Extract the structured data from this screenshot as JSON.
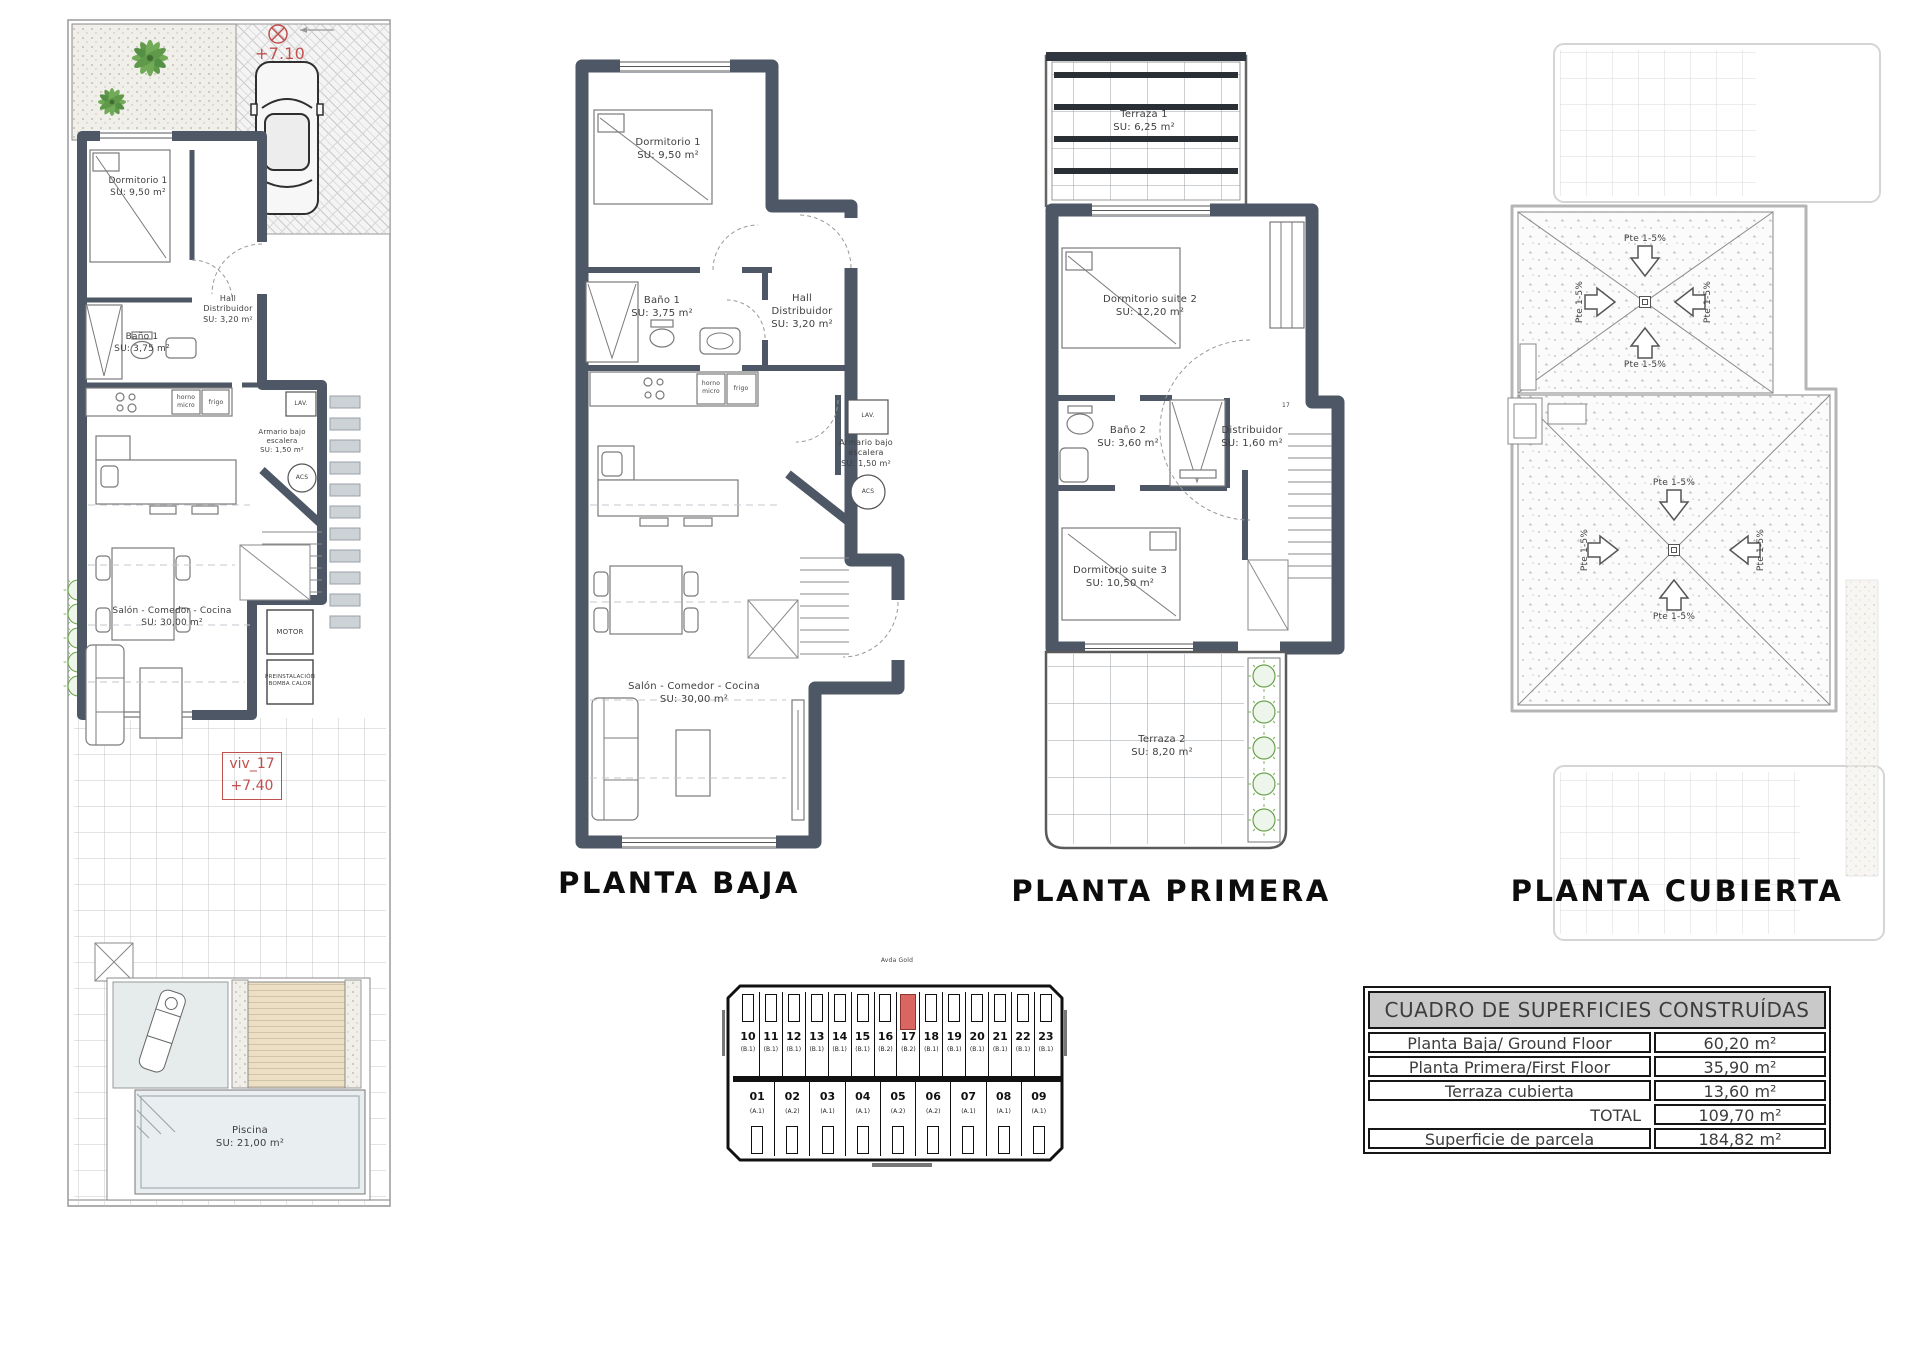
{
  "rooms": {
    "dorm1": {
      "name": "Dormitorio 1",
      "area": "SU: 9,50 m²"
    },
    "bano1": {
      "name": "Baño 1",
      "area": "SU: 3,75 m²"
    },
    "hall": {
      "line1": "Hall",
      "line2": "Distribuidor",
      "area": "SU: 3,20 m²"
    },
    "armario": {
      "line1": "Armario bajo",
      "line2": "escalera",
      "area": "SU: 1,50 m²"
    },
    "salon": {
      "name": "Salón - Comedor - Cocina",
      "area": "SU: 30,00 m²"
    },
    "piscina": {
      "name": "Piscina",
      "area": "SU: 21,00 m²"
    },
    "terraza1": {
      "name": "Terraza 1",
      "area": "SU: 6,25 m²"
    },
    "suite2": {
      "name": "Dormitorio suite 2",
      "area": "SU: 12,20 m²"
    },
    "bano2": {
      "name": "Baño 2",
      "area": "SU: 3,60 m²"
    },
    "distribuidor": {
      "name": "Distribuidor",
      "area": "SU: 1,60 m²"
    },
    "suite3": {
      "name": "Dormitorio suite 3",
      "area": "SU: 10,50 m²"
    },
    "terraza2": {
      "name": "Terraza 2",
      "area": "SU: 8,20 m²"
    }
  },
  "annotations": {
    "level_street": "+7.10",
    "unit_ref": "viv_17",
    "unit_level": "+7.40",
    "stair_ref": "17",
    "slope": "Pte 1-5%"
  },
  "equipment": {
    "motor": "MOTOR",
    "preinst1": "PREINSTALACIÓN",
    "preinst2": "BOMBA CALOR",
    "lav": "LAV.",
    "acs": "ACS",
    "horno1": "horno",
    "horno2": "micro",
    "frigo": "frigo"
  },
  "titles": {
    "baja": "PLANTA BAJA",
    "primera": "PLANTA PRIMERA",
    "cubierta": "PLANTA CUBIERTA"
  },
  "key_plan": {
    "street_top": "Avda Gold",
    "highlighted_unit": "17",
    "top_units": [
      {
        "n": "10",
        "t": "(B.1)"
      },
      {
        "n": "11",
        "t": "(B.1)"
      },
      {
        "n": "12",
        "t": "(B.1)"
      },
      {
        "n": "13",
        "t": "(B.1)"
      },
      {
        "n": "14",
        "t": "(B.1)"
      },
      {
        "n": "15",
        "t": "(B.1)"
      },
      {
        "n": "16",
        "t": "(B.2)"
      },
      {
        "n": "17",
        "t": "(B.2)"
      },
      {
        "n": "18",
        "t": "(B.1)"
      },
      {
        "n": "19",
        "t": "(B.1)"
      },
      {
        "n": "20",
        "t": "(B.1)"
      },
      {
        "n": "21",
        "t": "(B.1)"
      },
      {
        "n": "22",
        "t": "(B.1)"
      },
      {
        "n": "23",
        "t": "(B.1)"
      }
    ],
    "bottom_units": [
      {
        "n": "01",
        "t": "(A.1)"
      },
      {
        "n": "02",
        "t": "(A.2)"
      },
      {
        "n": "03",
        "t": "(A.1)"
      },
      {
        "n": "04",
        "t": "(A.1)"
      },
      {
        "n": "05",
        "t": "(A.2)"
      },
      {
        "n": "06",
        "t": "(A.2)"
      },
      {
        "n": "07",
        "t": "(A.1)"
      },
      {
        "n": "08",
        "t": "(A.1)"
      },
      {
        "n": "09",
        "t": "(A.1)"
      }
    ]
  },
  "areas_table": {
    "title": "CUADRO DE SUPERFICIES CONSTRUÍDAS",
    "rows": [
      {
        "label": "Planta Baja/ Ground Floor",
        "value": "60,20 m²"
      },
      {
        "label": "Planta Primera/First Floor",
        "value": "35,90 m²"
      },
      {
        "label": "Terraza cubierta",
        "value": "13,60 m²"
      },
      {
        "label": "TOTAL",
        "value": "109,70 m²"
      },
      {
        "label": "Superficie de parcela",
        "value": "184,82 m²"
      }
    ]
  }
}
